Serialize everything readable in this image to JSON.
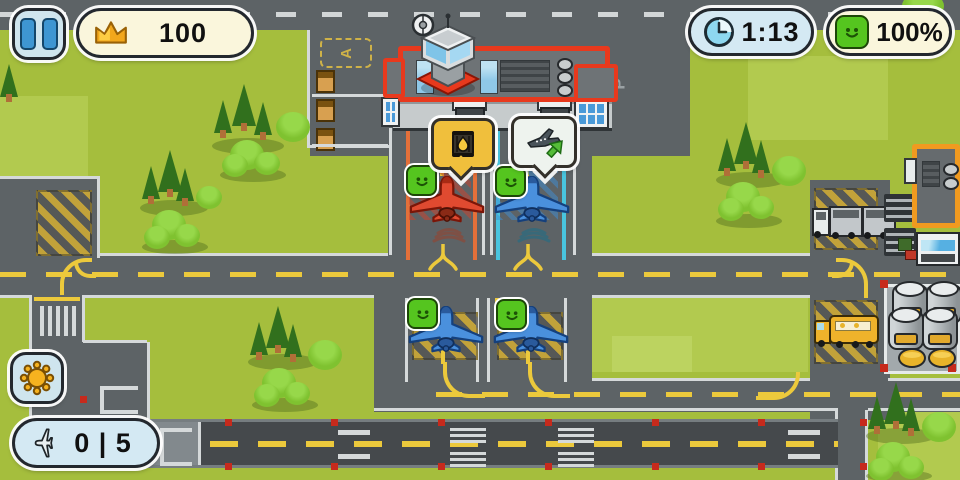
{
  "hud": {
    "pause_button": {
      "icon": "pause-icon"
    },
    "money": {
      "icon": "crown-icon",
      "value": "100"
    },
    "timer": {
      "icon": "clock-icon",
      "value": "1:13"
    },
    "happiness": {
      "icon": "happy-face-icon",
      "value": "100%"
    },
    "weather_button": {
      "icon": "sun-icon"
    },
    "flight_counter": {
      "icon": "plane-icon",
      "value": "0 | 5"
    }
  },
  "map": {
    "labels": {
      "stand_area": "A",
      "parking": "P"
    },
    "planes": [
      {
        "name": "plane-gate-1",
        "color": "#e04a30",
        "stand": "gate-left",
        "mood": "happy",
        "request": "fuel"
      },
      {
        "name": "plane-gate-2",
        "color": "#4a90dd",
        "stand": "gate-right",
        "mood": "happy",
        "request": "takeoff"
      },
      {
        "name": "plane-taxi-1",
        "color": "#4a90dd",
        "stand": "taxi-left",
        "mood": "happy"
      },
      {
        "name": "plane-taxi-2",
        "color": "#4a90dd",
        "stand": "taxi-right",
        "mood": "happy"
      }
    ],
    "request_bubbles": [
      {
        "type": "fuel",
        "icon": "oil-barrel-icon"
      },
      {
        "type": "takeoff",
        "icon": "plane-takeoff-icon"
      }
    ]
  },
  "colors": {
    "grass": "#a5be3d",
    "road": "#5d6366",
    "runway": "#45494c",
    "marking_yellow": "#ecc93c",
    "terminal_red": "#e8391d",
    "warehouse_orange": "#f09a20",
    "hud_cream": "#faf6dc",
    "hud_blue": "#d4e9f3",
    "smiley_green": "#55c51f"
  }
}
